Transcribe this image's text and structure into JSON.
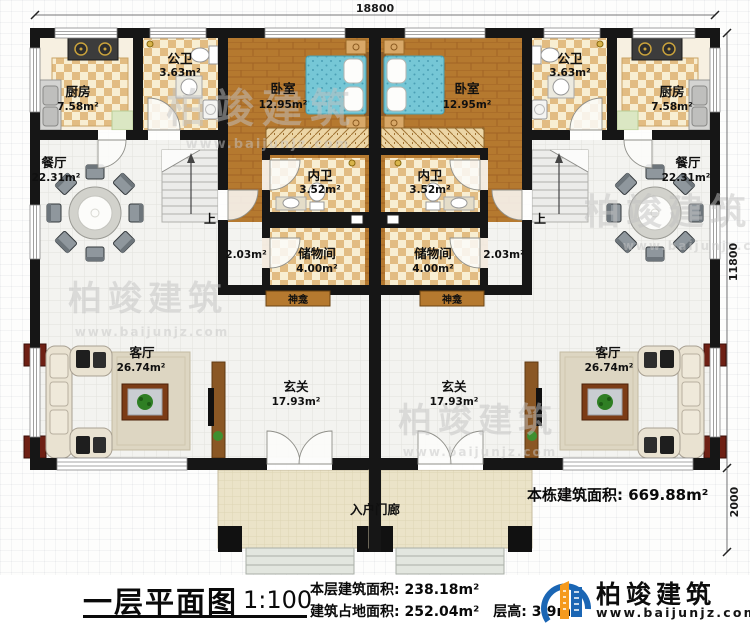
{
  "dimensions": {
    "top": "18800",
    "right": "11800",
    "porch_depth": "2000"
  },
  "rooms": {
    "kitchen_left": {
      "name": "厨房",
      "area": "7.58m²"
    },
    "kitchen_right": {
      "name": "厨房",
      "area": "7.58m²"
    },
    "bath_left": {
      "name": "公卫",
      "area": "3.63m²"
    },
    "bath_right": {
      "name": "公卫",
      "area": "3.63m²"
    },
    "bedroom_left": {
      "name": "卧室",
      "area": "12.95m²"
    },
    "bedroom_right": {
      "name": "卧室",
      "area": "12.95m²"
    },
    "dining_left": {
      "name": "餐厅",
      "area": "22.31m²"
    },
    "dining_right": {
      "name": "餐厅",
      "area": "22.31m²"
    },
    "ensuite_left": {
      "name": "内卫",
      "area": "3.52m²"
    },
    "ensuite_right": {
      "name": "内卫",
      "area": "3.52m²"
    },
    "storage_left": {
      "name": "储物间",
      "area": "4.00m²"
    },
    "storage_right": {
      "name": "储物间",
      "area": "4.00m²"
    },
    "understair_left": {
      "area": "2.03m²"
    },
    "understair_right": {
      "area": "2.03m²"
    },
    "shrine_left": {
      "name": "神龛"
    },
    "shrine_right": {
      "name": "神龛"
    },
    "living_left": {
      "name": "客厅",
      "area": "26.74m²"
    },
    "living_right": {
      "name": "客厅",
      "area": "26.74m²"
    },
    "foyer_left": {
      "name": "玄关",
      "area": "17.93m²"
    },
    "foyer_right": {
      "name": "玄关",
      "area": "17.93m²"
    },
    "porch": {
      "name": "入户门廊"
    }
  },
  "stairs": {
    "up_left": "上",
    "up_right": "上"
  },
  "annotations": {
    "total_building_area": "本栋建筑面积: 669.88m²"
  },
  "footer": {
    "title": "一层平面图",
    "scale": "1:100",
    "floor_area": "本层建筑面积: 238.18m²",
    "footprint_area": "建筑占地面积: 252.04m²",
    "floor_height": "层高: 3.9m"
  },
  "brand": {
    "name": "柏竣建筑",
    "website": "www.baijunjz.com"
  },
  "watermark": {
    "text": "柏竣建筑",
    "website": "www.baijunjz.com"
  },
  "colors": {
    "wall": "#161616",
    "wood_floor": "#b5792f",
    "tile_floor": "#f3f3f0",
    "checker_tan": "#e2bc82",
    "checker_cream": "#f8eed2",
    "bed_teal": "#76c7d6",
    "porch": "#ebe3c8",
    "brand_blue": "#1b66b4",
    "brand_orange": "#f59a1d",
    "watermark_gray": "#c2c2c2"
  }
}
